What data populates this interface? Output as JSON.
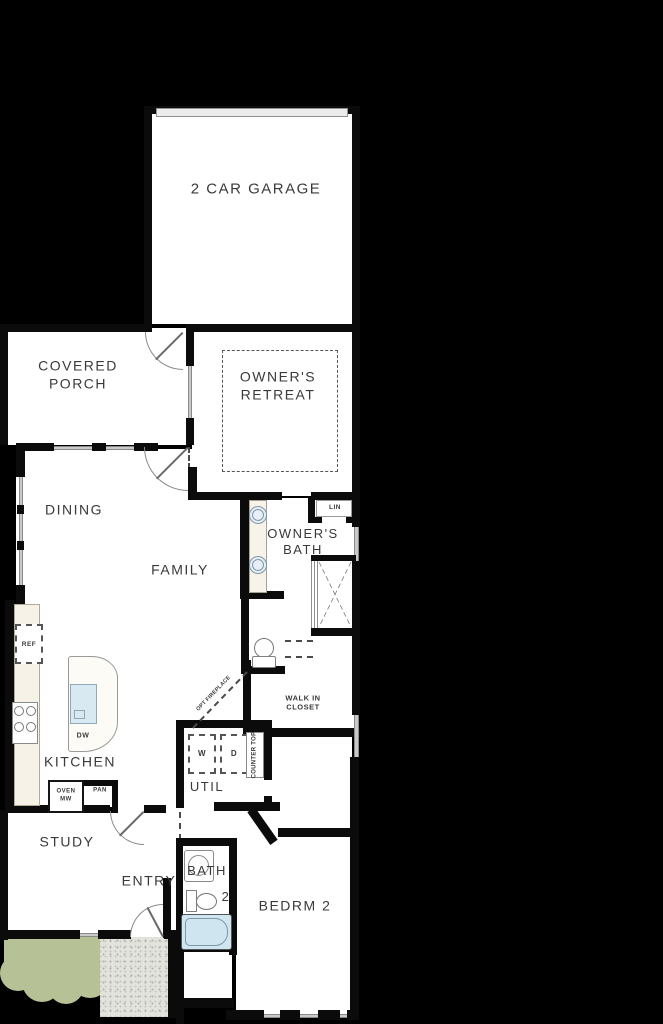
{
  "plan": {
    "rooms": {
      "garage": "2 CAR GARAGE",
      "covered_porch": "COVERED PORCH",
      "owners_retreat": "OWNER'S RETREAT",
      "dining": "DINING",
      "family": "FAMILY",
      "owners_bath": "OWNER'S BATH",
      "lin": "LIN",
      "walk_in_closet": "WALK IN CLOSET",
      "kitchen": "KITCHEN",
      "util": "UTIL",
      "study": "STUDY",
      "entry": "ENTRY",
      "bath2_line1": "BATH",
      "bath2_line2": "2",
      "bedrm2": "BEDRM 2"
    },
    "fixtures": {
      "ref": "REF",
      "dw": "DW",
      "oven_mw": "OVEN MW",
      "pan": "PAN",
      "washer": "W",
      "dryer": "D",
      "counter_top": "COUNTER TOP",
      "opt_fireplace": "OPT FIREPLACE"
    },
    "colors": {
      "background": "#000000",
      "wall": "#0b0b0b",
      "floor": "#ffffff",
      "fixture_blue": "#cfe5f0",
      "landscape_green": "#b6c295",
      "stoop_gray": "#e3e3de",
      "label_text": "#3a3a3a"
    }
  }
}
